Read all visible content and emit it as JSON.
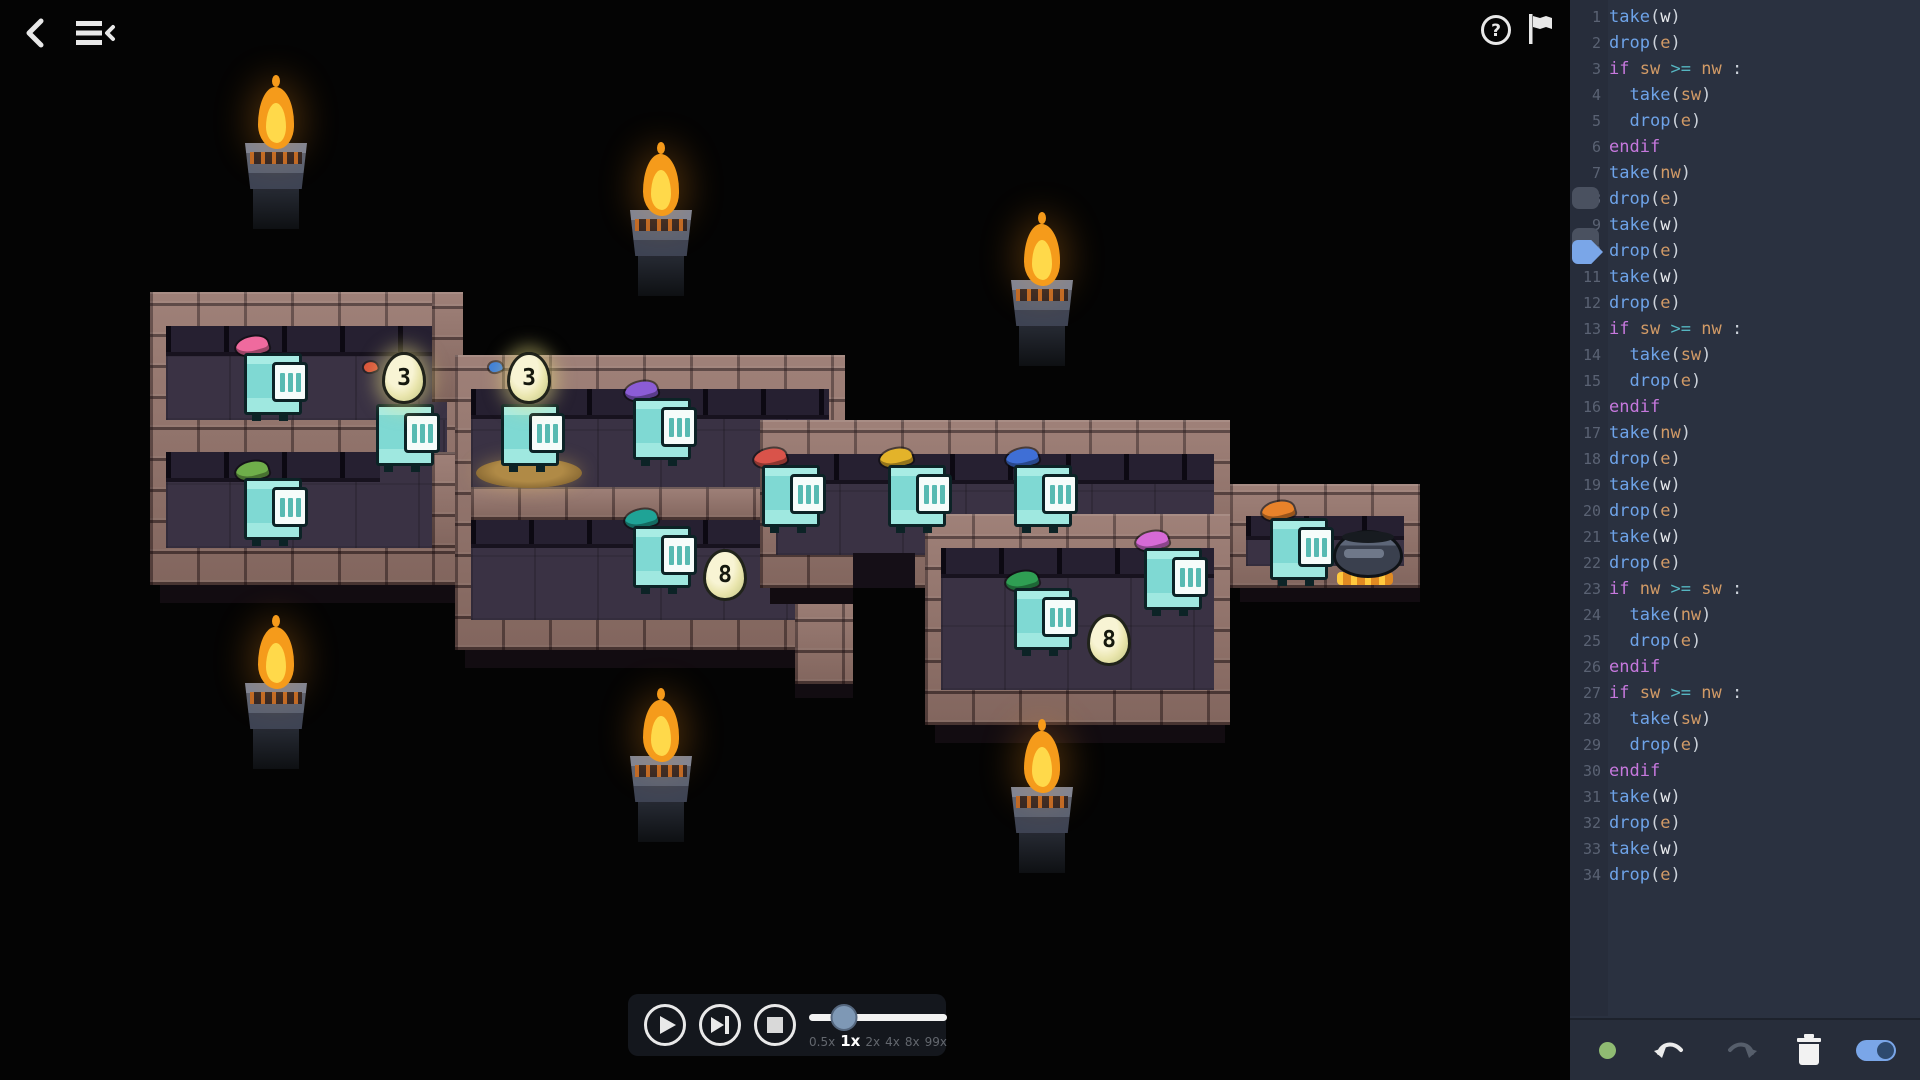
{
  "palette": {
    "accent": "#7aa6e8",
    "accent-dim": "#7e98b5",
    "status-green": "#8fbb72",
    "flame-orange": "#f59b1b",
    "flame-yellow": "#ffd94a"
  },
  "header": {
    "left_icons": [
      "back-chevron",
      "collapse-menu"
    ],
    "right_icons": [
      "help",
      "flag"
    ]
  },
  "scene": {
    "tiles": [
      {
        "k": "brick",
        "x": 150,
        "y": 292,
        "w": 313,
        "h": 293
      },
      {
        "k": "floor",
        "x": 166,
        "y": 326,
        "w": 281,
        "h": 94
      },
      {
        "k": "bench",
        "x": 166,
        "y": 326,
        "w": 281,
        "h": 26
      },
      {
        "k": "brick",
        "x": 432,
        "y": 292,
        "w": 31,
        "h": 110
      },
      {
        "k": "floor",
        "x": 380,
        "y": 420,
        "w": 67,
        "h": 34
      },
      {
        "k": "floor",
        "x": 166,
        "y": 452,
        "w": 281,
        "h": 96
      },
      {
        "k": "bench",
        "x": 166,
        "y": 452,
        "w": 214,
        "h": 26
      },
      {
        "k": "brick",
        "x": 432,
        "y": 452,
        "w": 31,
        "h": 96
      },
      {
        "k": "shadow",
        "x": 160,
        "y": 585,
        "w": 300,
        "h": 18
      },
      {
        "k": "brick",
        "x": 455,
        "y": 355,
        "w": 390,
        "h": 295
      },
      {
        "k": "floor",
        "x": 471,
        "y": 389,
        "w": 358,
        "h": 231
      },
      {
        "k": "bench",
        "x": 471,
        "y": 389,
        "w": 358,
        "h": 26
      },
      {
        "k": "brick",
        "x": 471,
        "y": 487,
        "w": 289,
        "h": 33
      },
      {
        "k": "bench",
        "x": 471,
        "y": 520,
        "w": 289,
        "h": 24
      },
      {
        "k": "shadow",
        "x": 465,
        "y": 650,
        "w": 380,
        "h": 18
      },
      {
        "k": "brick",
        "x": 760,
        "y": 420,
        "w": 470,
        "h": 168
      },
      {
        "k": "floor",
        "x": 776,
        "y": 454,
        "w": 438,
        "h": 101
      },
      {
        "k": "bench",
        "x": 776,
        "y": 454,
        "w": 438,
        "h": 26
      },
      {
        "k": "hole",
        "x": 853,
        "y": 553,
        "w": 62,
        "h": 35
      },
      {
        "k": "brick",
        "x": 795,
        "y": 588,
        "w": 58,
        "h": 96
      },
      {
        "k": "shadow",
        "x": 770,
        "y": 588,
        "w": 83,
        "h": 16
      },
      {
        "k": "shadow",
        "x": 795,
        "y": 684,
        "w": 58,
        "h": 14
      },
      {
        "k": "brick",
        "x": 925,
        "y": 514,
        "w": 305,
        "h": 211
      },
      {
        "k": "floor",
        "x": 941,
        "y": 548,
        "w": 273,
        "h": 142
      },
      {
        "k": "bench",
        "x": 941,
        "y": 548,
        "w": 273,
        "h": 26
      },
      {
        "k": "shadow",
        "x": 935,
        "y": 725,
        "w": 290,
        "h": 18
      },
      {
        "k": "brick",
        "x": 1230,
        "y": 484,
        "w": 190,
        "h": 104
      },
      {
        "k": "floor",
        "x": 1246,
        "y": 516,
        "w": 158,
        "h": 50
      },
      {
        "k": "bench",
        "x": 1246,
        "y": 516,
        "w": 158,
        "h": 20
      },
      {
        "k": "shadow",
        "x": 1240,
        "y": 588,
        "w": 180,
        "h": 14
      }
    ],
    "torches": [
      {
        "x": 238,
        "y": 75
      },
      {
        "x": 623,
        "y": 142
      },
      {
        "x": 1004,
        "y": 212
      },
      {
        "x": 238,
        "y": 615
      },
      {
        "x": 623,
        "y": 688
      },
      {
        "x": 1004,
        "y": 719
      }
    ],
    "robots": [
      {
        "x": 272,
        "y": 380,
        "plume": "#ef6a9e"
      },
      {
        "x": 404,
        "y": 431,
        "plume": "#d9533a",
        "egg": "3"
      },
      {
        "x": 529,
        "y": 431,
        "plume": "#3d7fd9",
        "egg": "3",
        "mound": true
      },
      {
        "x": 661,
        "y": 425,
        "plume": "#8b5cd6"
      },
      {
        "x": 272,
        "y": 505,
        "plume": "#6fae4a"
      },
      {
        "x": 661,
        "y": 553,
        "plume": "#1fa396"
      },
      {
        "x": 790,
        "y": 492,
        "plume": "#d9534a"
      },
      {
        "x": 916,
        "y": 492,
        "plume": "#e3b32a"
      },
      {
        "x": 1042,
        "y": 492,
        "plume": "#3f6fd6"
      },
      {
        "x": 1172,
        "y": 575,
        "plume": "#d66ad6"
      },
      {
        "x": 1042,
        "y": 615,
        "plume": "#2f9e53"
      },
      {
        "x": 1298,
        "y": 545,
        "plume": "#e8822a"
      }
    ],
    "floor_eggs": [
      {
        "x": 722,
        "y": 572,
        "label": "8"
      },
      {
        "x": 1106,
        "y": 637,
        "label": "8"
      }
    ],
    "cauldron": {
      "x": 1365,
      "y": 556
    }
  },
  "playback": {
    "buttons": [
      "play",
      "step",
      "stop"
    ],
    "speeds": [
      "0.5x",
      "1x",
      "2x",
      "4x",
      "8x",
      "99x"
    ],
    "active_speed": "1x",
    "slider_pct": 25
  },
  "editor": {
    "colors": {
      "f": "#6ea3e8",
      "k": "#c678dd",
      "o": "#d19a66",
      "w": "#e8eaed",
      "op": "#56b6c2",
      "p": "#ccd2da",
      "ln": "#5a6273"
    },
    "markers": [
      {
        "line": 8,
        "type": "gray",
        "dy": 0
      },
      {
        "line": 10,
        "type": "gray",
        "dy": -11
      },
      {
        "line": 10,
        "type": "blue",
        "dy": 1
      }
    ],
    "lines": [
      {
        "n": 1,
        "t": [
          [
            "f",
            "take"
          ],
          [
            "p",
            "("
          ],
          [
            "w",
            "w"
          ],
          [
            "p",
            ")"
          ]
        ]
      },
      {
        "n": 2,
        "t": [
          [
            "f",
            "drop"
          ],
          [
            "p",
            "("
          ],
          [
            "o",
            "e"
          ],
          [
            "p",
            ")"
          ]
        ]
      },
      {
        "n": 3,
        "t": [
          [
            "k",
            "if"
          ],
          [
            "p",
            " "
          ],
          [
            "o",
            "sw"
          ],
          [
            "p",
            " "
          ],
          [
            "op",
            ">="
          ],
          [
            "p",
            " "
          ],
          [
            "o",
            "nw"
          ],
          [
            "p",
            " "
          ],
          [
            "p",
            ":"
          ]
        ]
      },
      {
        "n": 4,
        "t": [
          [
            "p",
            "  "
          ],
          [
            "f",
            "take"
          ],
          [
            "p",
            "("
          ],
          [
            "o",
            "sw"
          ],
          [
            "p",
            ")"
          ]
        ]
      },
      {
        "n": 5,
        "t": [
          [
            "p",
            "  "
          ],
          [
            "f",
            "drop"
          ],
          [
            "p",
            "("
          ],
          [
            "o",
            "e"
          ],
          [
            "p",
            ")"
          ]
        ]
      },
      {
        "n": 6,
        "t": [
          [
            "k",
            "endif"
          ]
        ]
      },
      {
        "n": 7,
        "t": [
          [
            "f",
            "take"
          ],
          [
            "p",
            "("
          ],
          [
            "o",
            "nw"
          ],
          [
            "p",
            ")"
          ]
        ]
      },
      {
        "n": 8,
        "t": [
          [
            "f",
            "drop"
          ],
          [
            "p",
            "("
          ],
          [
            "o",
            "e"
          ],
          [
            "p",
            ")"
          ]
        ]
      },
      {
        "n": 9,
        "t": [
          [
            "f",
            "take"
          ],
          [
            "p",
            "("
          ],
          [
            "w",
            "w"
          ],
          [
            "p",
            ")"
          ]
        ]
      },
      {
        "n": 10,
        "t": [
          [
            "f",
            "drop"
          ],
          [
            "p",
            "("
          ],
          [
            "o",
            "e"
          ],
          [
            "p",
            ")"
          ]
        ]
      },
      {
        "n": 11,
        "t": [
          [
            "f",
            "take"
          ],
          [
            "p",
            "("
          ],
          [
            "w",
            "w"
          ],
          [
            "p",
            ")"
          ]
        ]
      },
      {
        "n": 12,
        "t": [
          [
            "f",
            "drop"
          ],
          [
            "p",
            "("
          ],
          [
            "o",
            "e"
          ],
          [
            "p",
            ")"
          ]
        ]
      },
      {
        "n": 13,
        "t": [
          [
            "k",
            "if"
          ],
          [
            "p",
            " "
          ],
          [
            "o",
            "sw"
          ],
          [
            "p",
            " "
          ],
          [
            "op",
            ">="
          ],
          [
            "p",
            " "
          ],
          [
            "o",
            "nw"
          ],
          [
            "p",
            " "
          ],
          [
            "p",
            ":"
          ]
        ]
      },
      {
        "n": 14,
        "t": [
          [
            "p",
            "  "
          ],
          [
            "f",
            "take"
          ],
          [
            "p",
            "("
          ],
          [
            "o",
            "sw"
          ],
          [
            "p",
            ")"
          ]
        ]
      },
      {
        "n": 15,
        "t": [
          [
            "p",
            "  "
          ],
          [
            "f",
            "drop"
          ],
          [
            "p",
            "("
          ],
          [
            "o",
            "e"
          ],
          [
            "p",
            ")"
          ]
        ]
      },
      {
        "n": 16,
        "t": [
          [
            "k",
            "endif"
          ]
        ]
      },
      {
        "n": 17,
        "t": [
          [
            "f",
            "take"
          ],
          [
            "p",
            "("
          ],
          [
            "o",
            "nw"
          ],
          [
            "p",
            ")"
          ]
        ]
      },
      {
        "n": 18,
        "t": [
          [
            "f",
            "drop"
          ],
          [
            "p",
            "("
          ],
          [
            "o",
            "e"
          ],
          [
            "p",
            ")"
          ]
        ]
      },
      {
        "n": 19,
        "t": [
          [
            "f",
            "take"
          ],
          [
            "p",
            "("
          ],
          [
            "w",
            "w"
          ],
          [
            "p",
            ")"
          ]
        ]
      },
      {
        "n": 20,
        "t": [
          [
            "f",
            "drop"
          ],
          [
            "p",
            "("
          ],
          [
            "o",
            "e"
          ],
          [
            "p",
            ")"
          ]
        ]
      },
      {
        "n": 21,
        "t": [
          [
            "f",
            "take"
          ],
          [
            "p",
            "("
          ],
          [
            "w",
            "w"
          ],
          [
            "p",
            ")"
          ]
        ]
      },
      {
        "n": 22,
        "t": [
          [
            "f",
            "drop"
          ],
          [
            "p",
            "("
          ],
          [
            "o",
            "e"
          ],
          [
            "p",
            ")"
          ]
        ]
      },
      {
        "n": 23,
        "t": [
          [
            "k",
            "if"
          ],
          [
            "p",
            " "
          ],
          [
            "o",
            "nw"
          ],
          [
            "p",
            " "
          ],
          [
            "op",
            ">="
          ],
          [
            "p",
            " "
          ],
          [
            "o",
            "sw"
          ],
          [
            "p",
            " "
          ],
          [
            "p",
            ":"
          ]
        ]
      },
      {
        "n": 24,
        "t": [
          [
            "p",
            "  "
          ],
          [
            "f",
            "take"
          ],
          [
            "p",
            "("
          ],
          [
            "o",
            "nw"
          ],
          [
            "p",
            ")"
          ]
        ]
      },
      {
        "n": 25,
        "t": [
          [
            "p",
            "  "
          ],
          [
            "f",
            "drop"
          ],
          [
            "p",
            "("
          ],
          [
            "o",
            "e"
          ],
          [
            "p",
            ")"
          ]
        ]
      },
      {
        "n": 26,
        "t": [
          [
            "k",
            "endif"
          ]
        ]
      },
      {
        "n": 27,
        "t": [
          [
            "k",
            "if"
          ],
          [
            "p",
            " "
          ],
          [
            "o",
            "sw"
          ],
          [
            "p",
            " "
          ],
          [
            "op",
            ">="
          ],
          [
            "p",
            " "
          ],
          [
            "o",
            "nw"
          ],
          [
            "p",
            " "
          ],
          [
            "p",
            ":"
          ]
        ]
      },
      {
        "n": 28,
        "t": [
          [
            "p",
            "  "
          ],
          [
            "f",
            "take"
          ],
          [
            "p",
            "("
          ],
          [
            "o",
            "sw"
          ],
          [
            "p",
            ")"
          ]
        ]
      },
      {
        "n": 29,
        "t": [
          [
            "p",
            "  "
          ],
          [
            "f",
            "drop"
          ],
          [
            "p",
            "("
          ],
          [
            "o",
            "e"
          ],
          [
            "p",
            ")"
          ]
        ]
      },
      {
        "n": 30,
        "t": [
          [
            "k",
            "endif"
          ]
        ]
      },
      {
        "n": 31,
        "t": [
          [
            "f",
            "take"
          ],
          [
            "p",
            "("
          ],
          [
            "w",
            "w"
          ],
          [
            "p",
            ")"
          ]
        ]
      },
      {
        "n": 32,
        "t": [
          [
            "f",
            "drop"
          ],
          [
            "p",
            "("
          ],
          [
            "o",
            "e"
          ],
          [
            "p",
            ")"
          ]
        ]
      },
      {
        "n": 33,
        "t": [
          [
            "f",
            "take"
          ],
          [
            "p",
            "("
          ],
          [
            "w",
            "w"
          ],
          [
            "p",
            ")"
          ]
        ]
      },
      {
        "n": 34,
        "t": [
          [
            "f",
            "drop"
          ],
          [
            "p",
            "("
          ],
          [
            "o",
            "e"
          ],
          [
            "p",
            ")"
          ]
        ]
      }
    ]
  },
  "toolbar": {
    "icons": [
      "status-dot",
      "undo",
      "redo",
      "trash",
      "toggle"
    ],
    "toggle_on": true
  }
}
